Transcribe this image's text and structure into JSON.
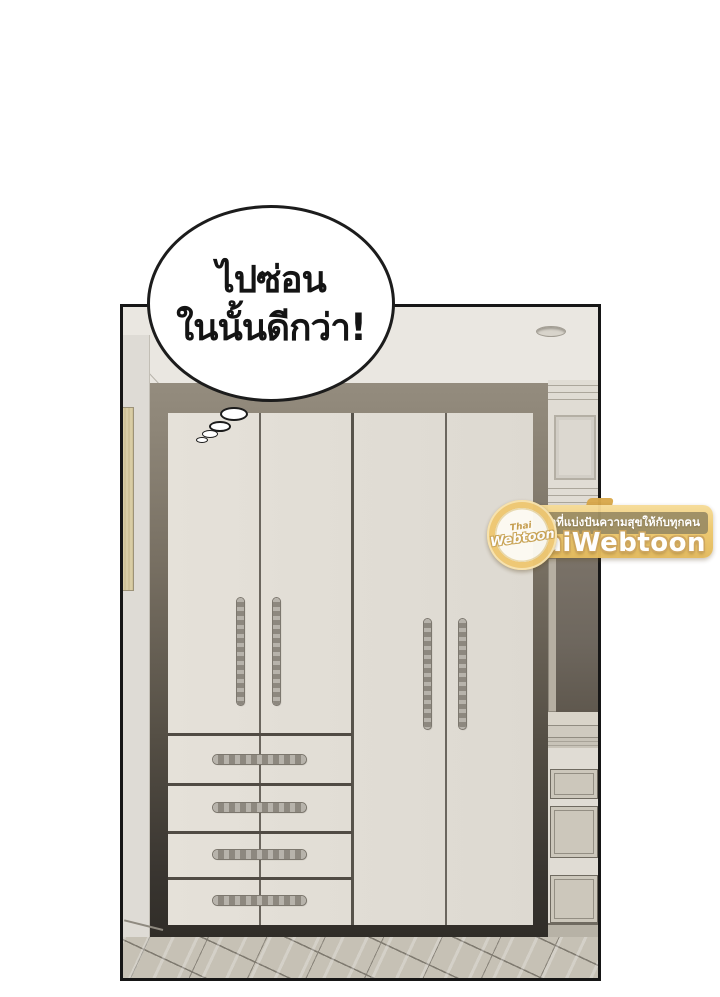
{
  "comic": {
    "speech_bubble": {
      "line1": "ไปซ่อน",
      "line2": "ในนั้นดีกว่า!"
    }
  },
  "watermark": {
    "tagline": "เว็บสนุกที่แบ่งปันความสุขให้กับทุกคน",
    "site_name": "ThaiWebtoon",
    "logo": {
      "top_word": "Thai",
      "main_word": "Webtoon"
    },
    "colors": {
      "gold": "#eec96f",
      "tan_strip": "#968860",
      "text": "#ffffff"
    }
  },
  "scene": {
    "objects": [
      "ceiling-recessed-light",
      "wardrobe",
      "wall-art",
      "mirror-panel",
      "side-drawer-cabinet",
      "parquet-floor",
      "thought-bubble-trail"
    ],
    "colors": {
      "panel_border": "#161616",
      "ceiling": "#eae7e1",
      "wall": "#dedbd5",
      "wardrobe_frame_top": "#8e8678",
      "wardrobe_frame_dark": "#2e2b26",
      "door_cream": "#e2ded6",
      "handle_gray": "#8d887f",
      "mirror": "#6e675e",
      "floor": "#c6c1b5"
    }
  }
}
